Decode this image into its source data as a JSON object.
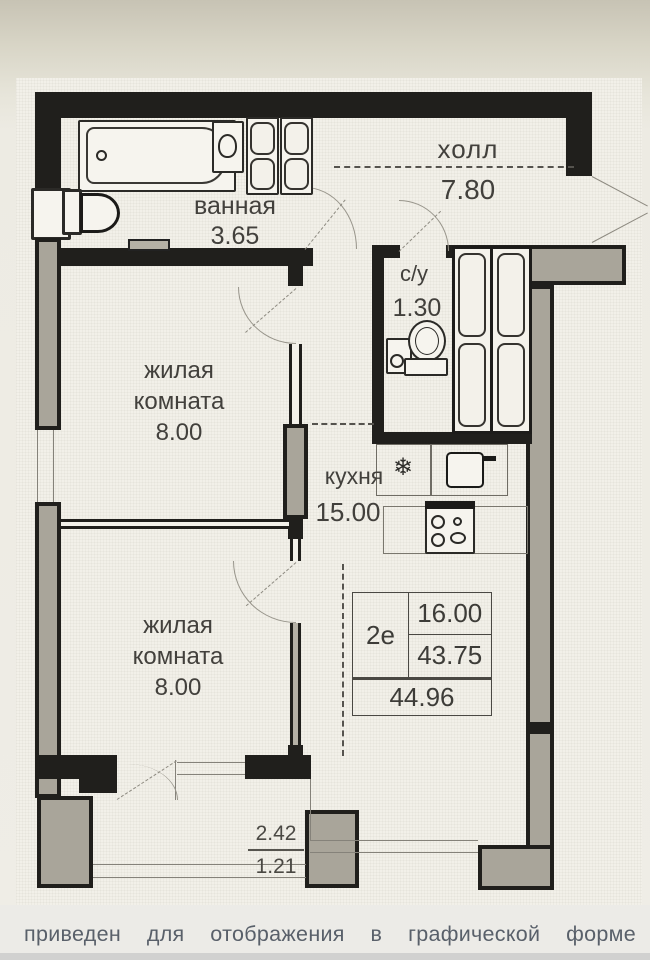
{
  "plan": {
    "hall": {
      "name": "холл",
      "area": "7.80"
    },
    "bathroom": {
      "name": "ванная",
      "area": "3.65"
    },
    "wc": {
      "name": "с/у",
      "area": "1.30"
    },
    "kitchen": {
      "name": "кухня",
      "area": "15.00"
    },
    "room1": {
      "name_line1": "жилая",
      "name_line2": "комната",
      "area": "8.00"
    },
    "room2": {
      "name_line1": "жилая",
      "name_line2": "комната",
      "area": "8.00"
    },
    "area_table": {
      "unit_type": "2е",
      "living_area": "16.00",
      "area_without_balcony": "43.75",
      "total_area": "44.96"
    },
    "balcony": {
      "length": "2.42",
      "area": "1.21"
    },
    "fridge_icon": "❄"
  },
  "photo": {
    "caption_text": "приведен для отображения в графической форме",
    "caption_words": [
      "приведен",
      "для",
      "отображения",
      "в",
      "графической",
      "форме"
    ]
  },
  "colors": {
    "wall": "#201f1c",
    "hatch": "#a9a59a",
    "paper": "#f2f0e9",
    "caption": "#59606a"
  }
}
